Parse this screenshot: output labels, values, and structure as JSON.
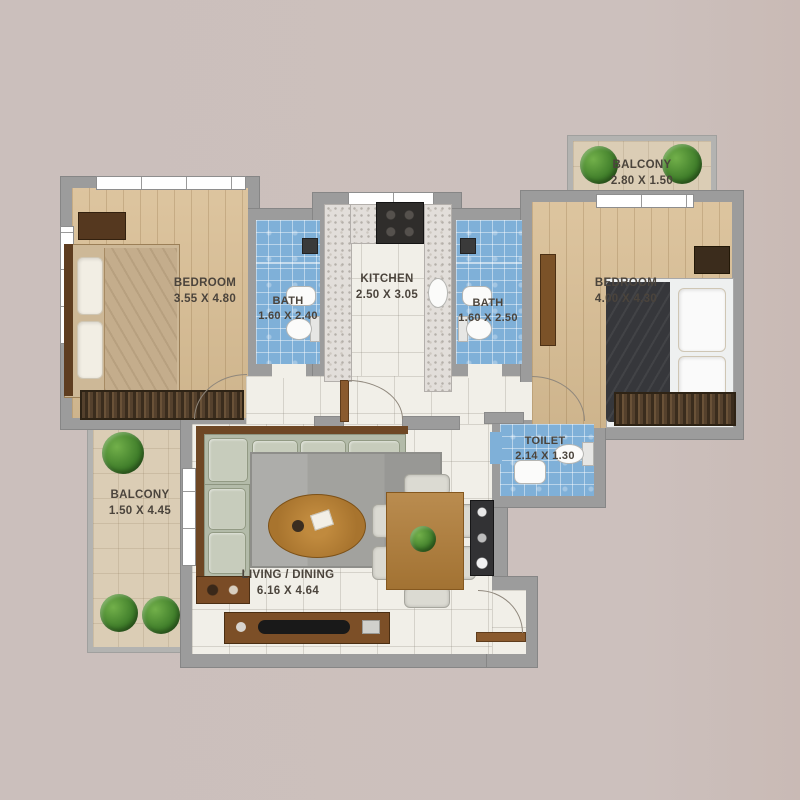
{
  "plan_title": "apartment-floor-plan",
  "colors": {
    "background": "#cbbfbc",
    "wall": "#9c9c9c",
    "wood_floor": "#d9be94",
    "bath_tile": "#7fb0d8",
    "balcony_tile": "#dbcdb5",
    "living_tile": "#f1efe8",
    "label_text": "#4b443c"
  },
  "rooms": [
    {
      "name": "balcony-top",
      "label": "BALCONY",
      "dims": "2.80 X 1.50"
    },
    {
      "name": "bedroom-left",
      "label": "BEDROOM",
      "dims": "3.55 X 4.80"
    },
    {
      "name": "bath-left",
      "label": "BATH",
      "dims": "1.60 X 2.40"
    },
    {
      "name": "kitchen",
      "label": "KITCHEN",
      "dims": "2.50 X 3.05"
    },
    {
      "name": "bath-right",
      "label": "BATH",
      "dims": "1.60 X 2.50"
    },
    {
      "name": "bedroom-right",
      "label": "BEDROOM",
      "dims": "4.00 X 4.30"
    },
    {
      "name": "toilet",
      "label": "TOILET",
      "dims": "2.14 X 1.30"
    },
    {
      "name": "balcony-left",
      "label": "BALCONY",
      "dims": "1.50 X 4.45"
    },
    {
      "name": "living-dining",
      "label": "LIVING / DINING",
      "dims": "6.16 X 4.64"
    }
  ]
}
